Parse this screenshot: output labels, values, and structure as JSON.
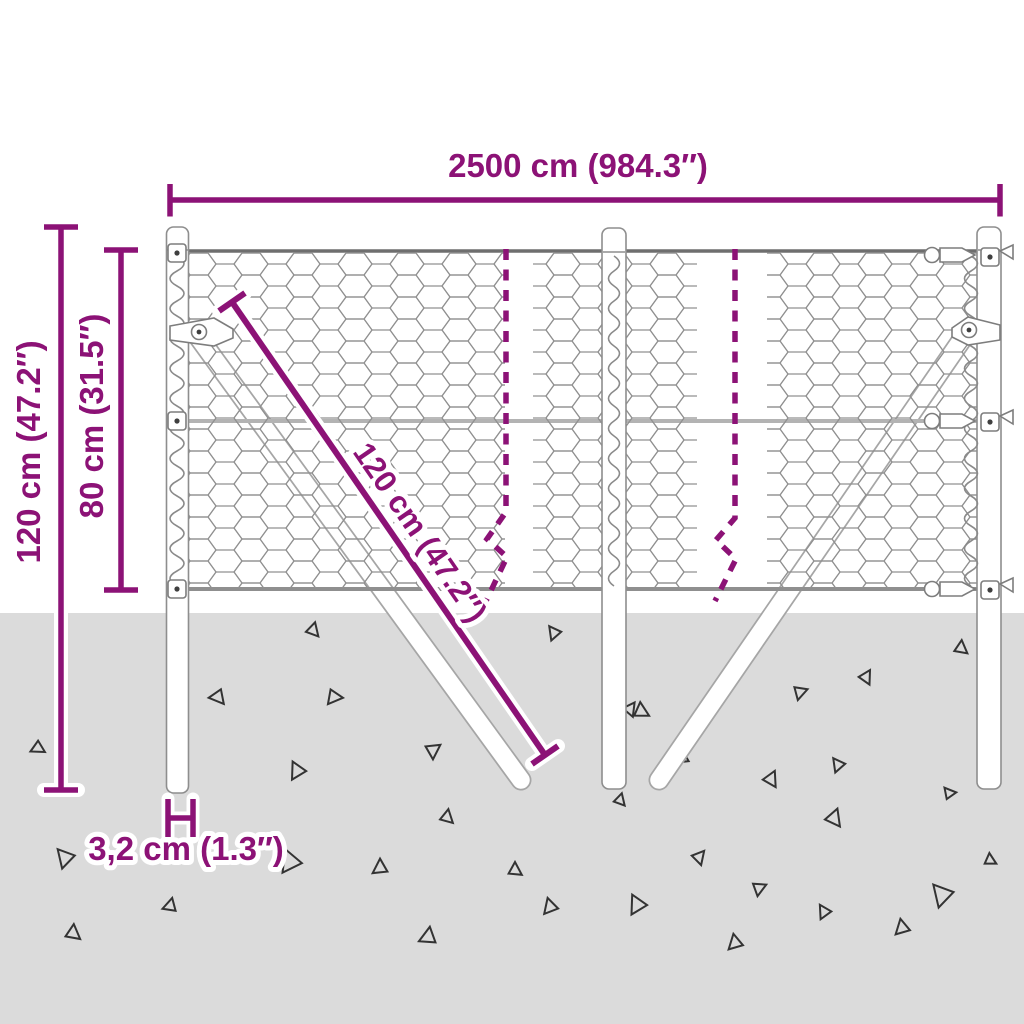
{
  "diagram": {
    "kind": "product dimension diagram",
    "subject": "chain-link fence with ground posts and braces"
  },
  "dimensions": {
    "total_width": "2500 cm (984.3″)",
    "total_height": "120 cm (47.2″)",
    "fence_height": "80 cm (31.5″)",
    "brace_length": "120 cm (47.2″)",
    "post_diameter": "3,2 cm (1.3″)"
  },
  "colors": {
    "dimension_accent": "#8C1276",
    "ground": "#DBDBDB",
    "mesh_wire": "#909090",
    "debris_outline": "#333333"
  }
}
